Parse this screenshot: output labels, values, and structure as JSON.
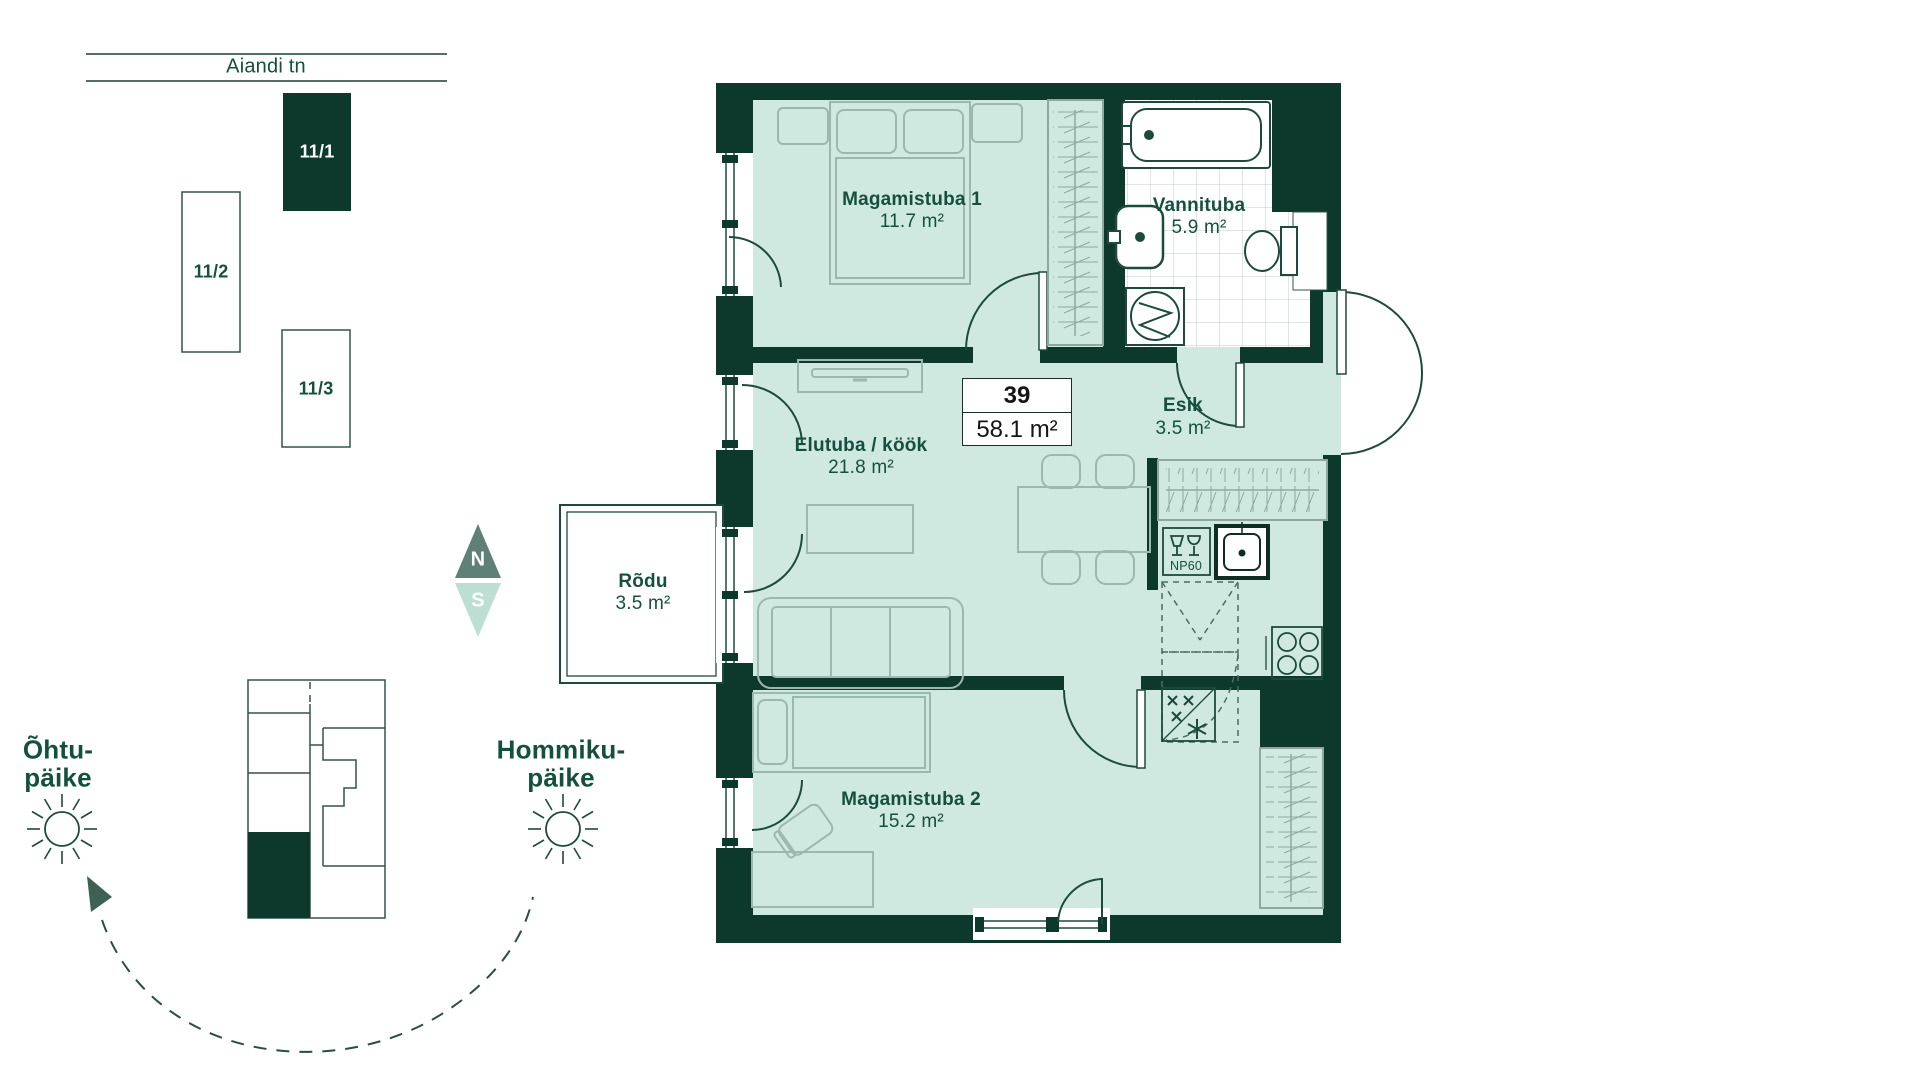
{
  "street": {
    "name": "Aiandi tn"
  },
  "buildings": [
    {
      "label": "11/1",
      "highlighted": true
    },
    {
      "label": "11/2",
      "highlighted": false
    },
    {
      "label": "11/3",
      "highlighted": false
    }
  ],
  "compass": {
    "north": "N",
    "south": "S"
  },
  "sun": {
    "evening_line1": "Õhtu-",
    "evening_line2": "päike",
    "morning_line1": "Hommiku-",
    "morning_line2": "päike"
  },
  "apartment": {
    "number": "39",
    "area": "58.1 m²"
  },
  "rooms": [
    {
      "name": "Magamistuba 1",
      "area": "11.7 m²"
    },
    {
      "name": "Vannituba",
      "area": "5.9 m²"
    },
    {
      "name": "Elutuba / köök",
      "area": "21.8 m²"
    },
    {
      "name": "Esik",
      "area": "3.5 m²"
    },
    {
      "name": "Rõdu",
      "area": "3.5 m²"
    },
    {
      "name": "Magamistuba 2",
      "area": "15.2 m²"
    }
  ],
  "kitchen": {
    "dishwasher_label": "NP60"
  },
  "colors": {
    "wall": "#0c392b",
    "room_fill": "#cfe8e0",
    "furniture": "#9cb7ae",
    "fixture": "#1d4a3c",
    "text": "#14503e",
    "compass_north": "#5f8076",
    "compass_south": "#bcded3"
  }
}
